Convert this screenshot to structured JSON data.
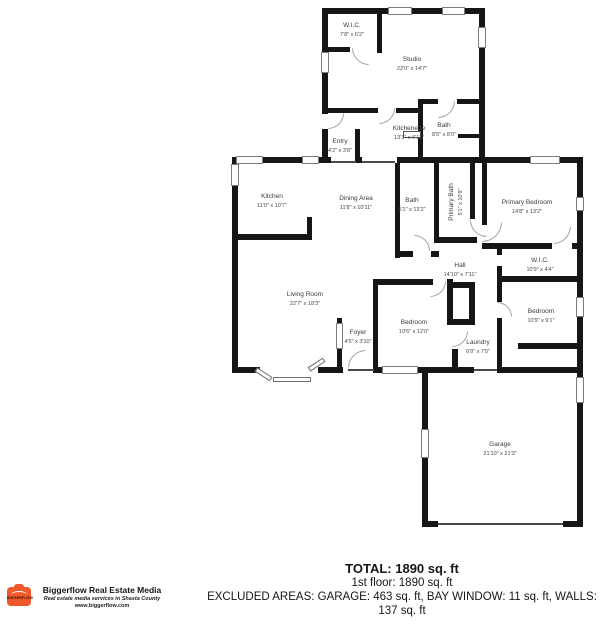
{
  "floorplan": {
    "rooms": [
      {
        "id": "wic-studio",
        "name": "W.I.C.",
        "dims": "7'8\" x 6'2\""
      },
      {
        "id": "studio",
        "name": "Studio",
        "dims": "22'0\" x 14'7\""
      },
      {
        "id": "kitchenette",
        "name": "Kitchenette",
        "dims": "13'3\" x 6'11\""
      },
      {
        "id": "bath-studio",
        "name": "Bath",
        "dims": "8'5\" x 8'0\""
      },
      {
        "id": "entry",
        "name": "Entry",
        "dims": "4'2\" x 3'8\""
      },
      {
        "id": "kitchen",
        "name": "Kitchen",
        "dims": "11'0\" x 10'7\""
      },
      {
        "id": "dining-area",
        "name": "Dining Area",
        "dims": "11'8\" x 10'11\""
      },
      {
        "id": "bath-main",
        "name": "Bath",
        "dims": "5'1\" x 13'2\""
      },
      {
        "id": "primary-bath",
        "name": "Primary Bath",
        "dims": "5'1\" x 10'9\""
      },
      {
        "id": "primary-bedroom",
        "name": "Primary Bedroom",
        "dims": "14'8\" x 13'2\""
      },
      {
        "id": "wic-primary",
        "name": "W.I.C.",
        "dims": "10'9\" x 4'4\""
      },
      {
        "id": "hall",
        "name": "Hall",
        "dims": "14'10\" x 7'11\""
      },
      {
        "id": "living-room",
        "name": "Living Room",
        "dims": "22'7\" x 18'3\""
      },
      {
        "id": "bedroom-left",
        "name": "Bedroom",
        "dims": "10'6\" x 12'0\""
      },
      {
        "id": "bedroom-right",
        "name": "Bedroom",
        "dims": "10'9\" x 9'1\""
      },
      {
        "id": "foyer",
        "name": "Foyer",
        "dims": "4'5\" x 3'10\""
      },
      {
        "id": "laundry",
        "name": "Laundry",
        "dims": "6'9\" x 7'5\""
      },
      {
        "id": "garage",
        "name": "Garage",
        "dims": "21'10\" x 21'3\""
      }
    ]
  },
  "summary": {
    "total": "TOTAL: 1890 sq. ft",
    "first_floor": "1st floor: 1890 sq. ft",
    "excluded": "EXCLUDED AREAS: GARAGE: 463 sq. ft, BAY WINDOW: 11 sq. ft, WALLS: 137 sq. ft",
    "disclaimer": "Measurement Are Highly Reliable But Not Guaranteed."
  },
  "branding": {
    "company": "Biggerflow Real Estate Media",
    "tagline": "Real estate media services in Shasta County",
    "website": "www.biggerflow.com",
    "badge_text": "BIGGERFLOW",
    "accent_color": "#F1582B"
  }
}
